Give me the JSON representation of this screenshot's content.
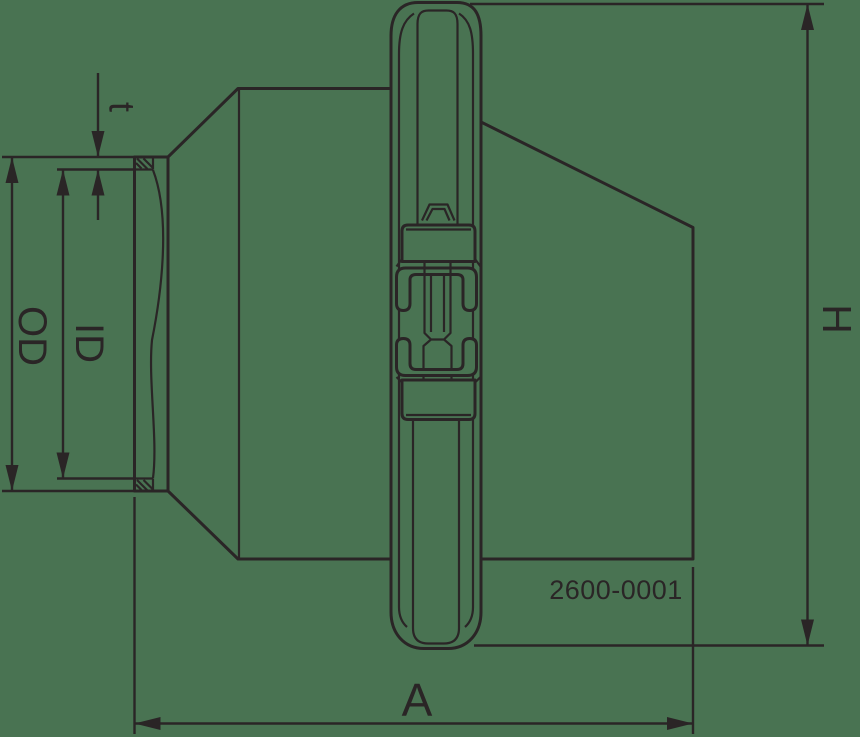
{
  "colors": {
    "background": "#497352",
    "line": "#2a2526"
  },
  "drawing": {
    "part_number": "2600-0001",
    "dimension_labels": {
      "wall_thickness": "t",
      "outer_diameter": "OD",
      "inner_diameter": "ID",
      "height": "H",
      "length": "A"
    }
  }
}
